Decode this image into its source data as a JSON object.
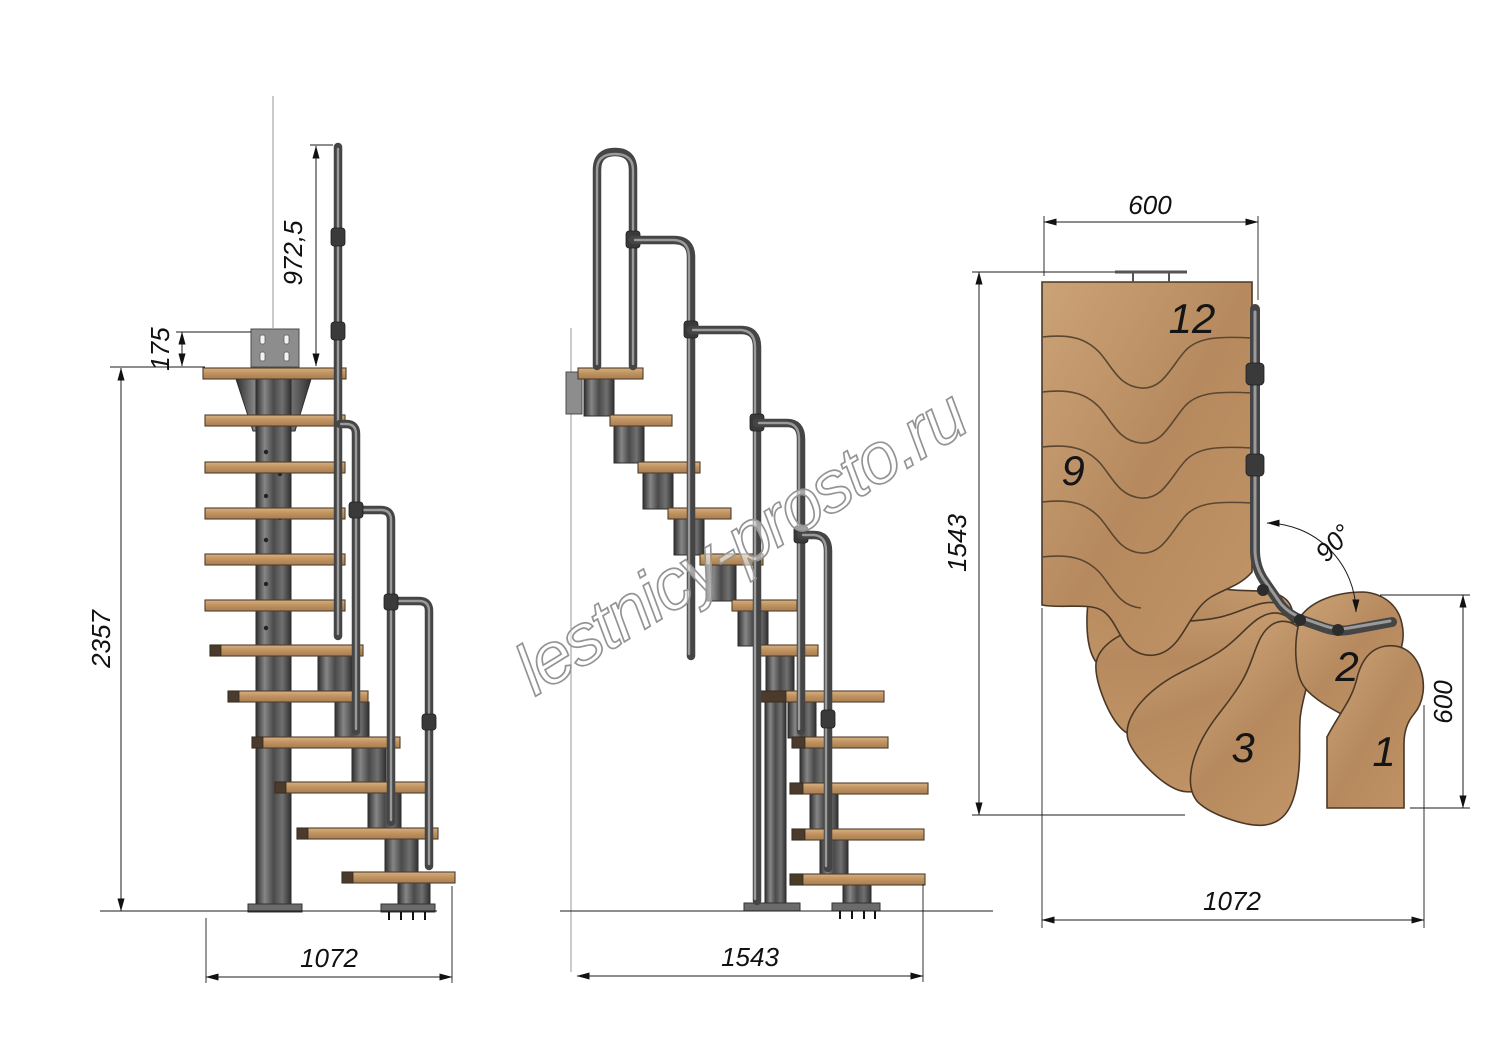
{
  "watermark": {
    "text": "lestnicy-prosto.ru"
  },
  "side_view": {
    "dim_handrail_height": "972,5",
    "dim_bracket_offset": "175",
    "dim_total_height": "2357",
    "dim_base_depth": "1072"
  },
  "front_view": {
    "dim_base_width": "1543"
  },
  "plan_view": {
    "dim_flight_width": "600",
    "dim_overall_depth": "1543",
    "dim_entry_depth": "600",
    "dim_overall_width": "1072",
    "dim_turn_angle": "90°",
    "step_numbers": {
      "top": "12",
      "middle": "9",
      "third": "3",
      "second": "2",
      "first": "1"
    }
  },
  "colors": {
    "wood": "#c09064",
    "metal": "#4f4f4f",
    "line": "#1b1b1b",
    "watermark_stroke": "#949494",
    "background": "#ffffff"
  }
}
